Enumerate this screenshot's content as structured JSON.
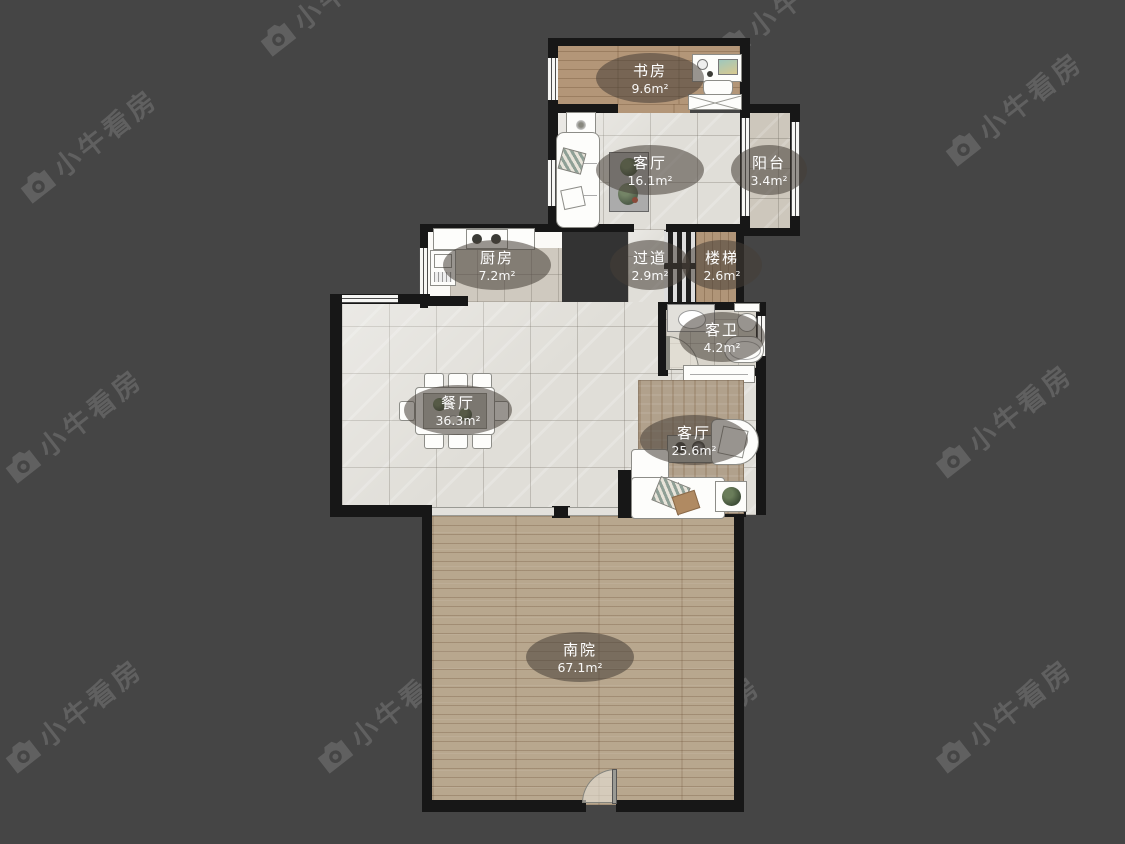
{
  "watermark": {
    "text": "小牛看房",
    "icon": "camera-icon",
    "color": "rgba(255,255,255,0.15)",
    "positions": [
      [
        5,
        125
      ],
      [
        245,
        -22
      ],
      [
        700,
        -15
      ],
      [
        930,
        88
      ],
      [
        -10,
        405
      ],
      [
        368,
        392
      ],
      [
        920,
        400
      ],
      [
        -10,
        695
      ],
      [
        302,
        695
      ],
      [
        608,
        712
      ],
      [
        920,
        695
      ]
    ]
  },
  "rooms": [
    {
      "name": "书房",
      "area": "9.6m²"
    },
    {
      "name": "客厅",
      "area": "16.1m²"
    },
    {
      "name": "阳台",
      "area": "3.4m²"
    },
    {
      "name": "厨房",
      "area": "7.2m²"
    },
    {
      "name": "过道",
      "area": "2.9m²"
    },
    {
      "name": "楼梯",
      "area": "2.6m²"
    },
    {
      "name": "客卫",
      "area": "4.2m²"
    },
    {
      "name": "餐厅",
      "area": "36.3m²"
    },
    {
      "name": "客厅",
      "area": "25.6m²"
    },
    {
      "name": "南院",
      "area": "67.1m²"
    }
  ],
  "colors": {
    "background": "#454545",
    "wall": "#171717",
    "tile_floor": "#e0ded8",
    "wood_floor": "#b39678",
    "yard_floor": "#b8a78e",
    "label_pill": "rgba(70,62,54,0.55)"
  }
}
